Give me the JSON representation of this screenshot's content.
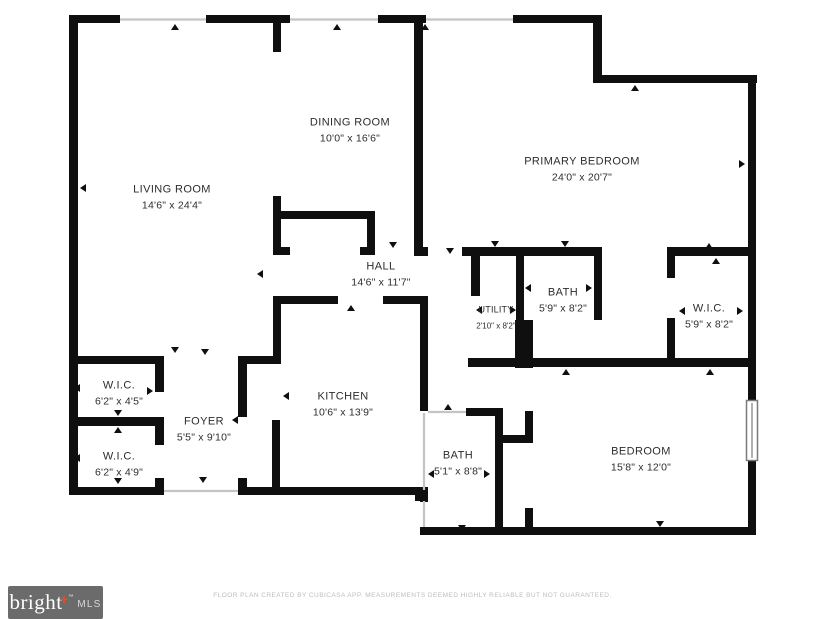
{
  "rooms": [
    {
      "id": "living-room",
      "name": "LIVING ROOM",
      "dims": "14'6\" x 24'4\""
    },
    {
      "id": "dining-room",
      "name": "DINING ROOM",
      "dims": "10'0\" x 16'6\""
    },
    {
      "id": "primary-bedroom",
      "name": "PRIMARY BEDROOM",
      "dims": "24'0\" x 20'7\""
    },
    {
      "id": "hall",
      "name": "HALL",
      "dims": "14'6\" x 11'7\""
    },
    {
      "id": "utility",
      "name": "UTILITY",
      "dims": "2'10\" x 8'2\""
    },
    {
      "id": "bath-upper",
      "name": "BATH",
      "dims": "5'9\" x 8'2\""
    },
    {
      "id": "wic-right",
      "name": "W.I.C.",
      "dims": "5'9\" x 8'2\""
    },
    {
      "id": "wic-upper-left",
      "name": "W.I.C.",
      "dims": "6'2\" x 4'5\""
    },
    {
      "id": "wic-lower-left",
      "name": "W.I.C.",
      "dims": "6'2\" x 4'9\""
    },
    {
      "id": "foyer",
      "name": "FOYER",
      "dims": "5'5\" x 9'10\""
    },
    {
      "id": "kitchen",
      "name": "KITCHEN",
      "dims": "10'6\" x 13'9\""
    },
    {
      "id": "bath-lower",
      "name": "BATH",
      "dims": "5'1\" x 8'8\""
    },
    {
      "id": "bedroom",
      "name": "BEDROOM",
      "dims": "15'8\" x 12'0\""
    }
  ],
  "footer": {
    "logo_text": "bright",
    "logo_plus": "+",
    "logo_tm": "™",
    "logo_suffix": "MLS",
    "disclaimer": "FLOOR PLAN CREATED BY CUBICASA APP. MEASUREMENTS DEEMED HIGHLY RELIABLE BUT NOT GUARANTEED."
  },
  "colors": {
    "wall": "#0f0f0f",
    "background": "#ffffff",
    "label_text": "#2d2d2d",
    "thin_line": "#c4c4c4",
    "window_frame": "#7a7a7a",
    "logo_bg": "#6b6b6b",
    "logo_plus": "#e0512c",
    "disclaimer_text": "#bdbdbd"
  }
}
